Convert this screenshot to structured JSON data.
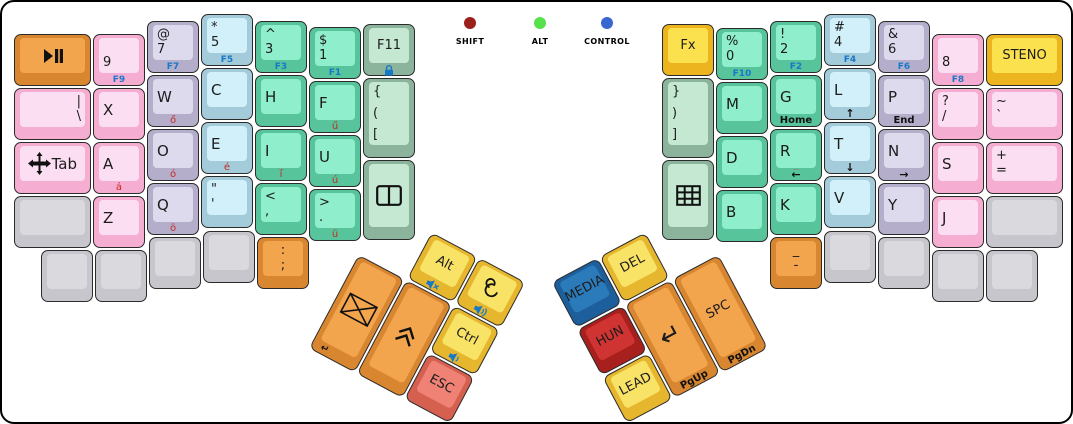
{
  "window": {
    "width": 1073,
    "height": 424,
    "background": "#ffffff",
    "border_color": "#000000"
  },
  "indicators": [
    {
      "name": "shift",
      "label": "SHIFT",
      "color": "#9b1f1a",
      "x": 468,
      "y": 21
    },
    {
      "name": "alt",
      "label": "ALT",
      "color": "#57e14b",
      "x": 538,
      "y": 21
    },
    {
      "name": "control",
      "label": "CONTROL",
      "color": "#3a66d2",
      "x": 605,
      "y": 21
    }
  ],
  "palette": {
    "pink": {
      "side": "#f5aed2",
      "face": "#fbdef1"
    },
    "lavender": {
      "side": "#b4aeca",
      "face": "#dedaee"
    },
    "cyan": {
      "side": "#a4cbd9",
      "face": "#d2f0fa"
    },
    "teal": {
      "side": "#58c49c",
      "face": "#8feecb"
    },
    "sage": {
      "side": "#8cb49c",
      "face": "#c4e8d1"
    },
    "gold": {
      "side": "#ecb51f",
      "face": "#fce14e"
    },
    "yellow": {
      "side": "#e5b62e",
      "face": "#f8e366"
    },
    "orange": {
      "side": "#d8862f",
      "face": "#f3a54e"
    },
    "salmon": {
      "side": "#d6604f",
      "face": "#ef8274"
    },
    "red": {
      "side": "#a8201e",
      "face": "#cf3432"
    },
    "blue": {
      "side": "#1d5e9c",
      "face": "#2b7ab9"
    },
    "gray": {
      "side": "#c6c6cc",
      "face": "#d9d9de"
    }
  },
  "keys": [
    {
      "name": "key-play-pause",
      "x": 12,
      "y": 32,
      "w": 77,
      "color": "orange",
      "center": "icon:play-pause"
    },
    {
      "name": "key-9",
      "x": 91,
      "y": 32,
      "color": "pink",
      "stack": [
        "",
        "9"
      ],
      "front": "F9",
      "fc": "blue"
    },
    {
      "name": "key-7",
      "x": 145,
      "y": 19,
      "color": "lavender",
      "stack": [
        "@",
        "7"
      ],
      "front": "F7",
      "fc": "blue"
    },
    {
      "name": "key-5",
      "x": 199,
      "y": 12,
      "color": "cyan",
      "stack": [
        "*",
        "5"
      ],
      "front": "F5",
      "fc": "blue"
    },
    {
      "name": "key-3",
      "x": 253,
      "y": 19,
      "color": "teal",
      "stack": [
        "^",
        "3"
      ],
      "front": "F3",
      "fc": "blue"
    },
    {
      "name": "key-1",
      "x": 307,
      "y": 25,
      "color": "teal",
      "stack": [
        "$",
        "1"
      ],
      "front": "F1",
      "fc": "blue"
    },
    {
      "name": "key-f11",
      "x": 361,
      "y": 22,
      "color": "sage",
      "center": "F11",
      "front": "icon:lock",
      "fc": "blue"
    },
    {
      "name": "key-pipe-backslash",
      "x": 12,
      "y": 86,
      "w": 77,
      "color": "pink",
      "stack": [
        "|",
        "\\"
      ],
      "align": "r"
    },
    {
      "name": "key-x",
      "x": 91,
      "y": 86,
      "color": "pink",
      "single": "X"
    },
    {
      "name": "key-w",
      "x": 145,
      "y": 73,
      "color": "lavender",
      "single": "W",
      "front": "ő",
      "fc": "red"
    },
    {
      "name": "key-c",
      "x": 199,
      "y": 66,
      "color": "cyan",
      "single": "C"
    },
    {
      "name": "key-h",
      "x": 253,
      "y": 73,
      "color": "teal",
      "single": "H"
    },
    {
      "name": "key-f",
      "x": 307,
      "y": 79,
      "color": "teal",
      "single": "F",
      "front": "ű",
      "fc": "red"
    },
    {
      "name": "key-brace-open",
      "x": 361,
      "y": 76,
      "h": 80,
      "color": "sage",
      "stack": [
        "{",
        "(",
        "["
      ]
    },
    {
      "name": "key-tab",
      "x": 12,
      "y": 140,
      "w": 77,
      "color": "pink",
      "row": [
        "icon:move",
        "Tab"
      ]
    },
    {
      "name": "key-a",
      "x": 91,
      "y": 140,
      "color": "pink",
      "single": "A",
      "front": "á",
      "fc": "red"
    },
    {
      "name": "key-o",
      "x": 145,
      "y": 127,
      "color": "lavender",
      "single": "O",
      "front": "ó",
      "fc": "red"
    },
    {
      "name": "key-e",
      "x": 199,
      "y": 120,
      "color": "cyan",
      "single": "E",
      "front": "é",
      "fc": "red"
    },
    {
      "name": "key-i",
      "x": 253,
      "y": 127,
      "color": "teal",
      "single": "I",
      "mid": "_",
      "front": "í",
      "fc": "red"
    },
    {
      "name": "key-u",
      "x": 307,
      "y": 133,
      "color": "teal",
      "single": "U",
      "front": "ú",
      "fc": "red"
    },
    {
      "name": "key-window",
      "x": 361,
      "y": 158,
      "h": 80,
      "color": "sage",
      "center": "icon:window-split"
    },
    {
      "name": "key-blank-l0",
      "x": 12,
      "y": 194,
      "w": 77,
      "color": "gray"
    },
    {
      "name": "key-z",
      "x": 91,
      "y": 194,
      "color": "pink",
      "single": "Z"
    },
    {
      "name": "key-q",
      "x": 145,
      "y": 181,
      "color": "lavender",
      "single": "Q",
      "front": "ö",
      "fc": "red"
    },
    {
      "name": "key-quote",
      "x": 199,
      "y": 174,
      "color": "cyan",
      "stack": [
        "\"",
        "'"
      ]
    },
    {
      "name": "key-comma",
      "x": 253,
      "y": 181,
      "color": "teal",
      "stack": [
        "<",
        ","
      ]
    },
    {
      "name": "key-period",
      "x": 307,
      "y": 187,
      "color": "teal",
      "stack": [
        ">",
        "."
      ],
      "front": "ü",
      "fc": "red"
    },
    {
      "name": "key-blank-l1",
      "x": 39,
      "y": 248,
      "color": "gray"
    },
    {
      "name": "key-blank-l2",
      "x": 93,
      "y": 248,
      "color": "gray"
    },
    {
      "name": "key-blank-l3",
      "x": 147,
      "y": 235,
      "color": "gray"
    },
    {
      "name": "key-blank-l4",
      "x": 201,
      "y": 229,
      "color": "gray"
    },
    {
      "name": "key-colon",
      "x": 255,
      "y": 235,
      "color": "orange",
      "stack": [
        ":",
        ";"
      ],
      "align": "c"
    },
    {
      "name": "key-fx",
      "x": 660,
      "y": 22,
      "color": "gold",
      "center": "Fx"
    },
    {
      "name": "key-0",
      "x": 714,
      "y": 26,
      "color": "teal",
      "stack": [
        "%",
        "0"
      ],
      "front": "F10",
      "fc": "blue"
    },
    {
      "name": "key-2",
      "x": 768,
      "y": 19,
      "color": "teal",
      "stack": [
        "!",
        "2"
      ],
      "front": "F2",
      "fc": "blue"
    },
    {
      "name": "key-4",
      "x": 822,
      "y": 12,
      "color": "cyan",
      "stack": [
        "#",
        "4"
      ],
      "front": "F4",
      "fc": "blue"
    },
    {
      "name": "key-6",
      "x": 876,
      "y": 19,
      "color": "lavender",
      "stack": [
        "&",
        "6"
      ],
      "front": "F6",
      "fc": "blue"
    },
    {
      "name": "key-8",
      "x": 930,
      "y": 32,
      "color": "pink",
      "stack": [
        "",
        "8"
      ],
      "front": "F8",
      "fc": "blue"
    },
    {
      "name": "key-steno",
      "x": 984,
      "y": 32,
      "w": 77,
      "color": "gold",
      "center": "STENO"
    },
    {
      "name": "key-brace-close",
      "x": 660,
      "y": 76,
      "h": 80,
      "color": "sage",
      "stack": [
        "}",
        ")",
        "]"
      ]
    },
    {
      "name": "key-m",
      "x": 714,
      "y": 80,
      "color": "teal",
      "single": "M"
    },
    {
      "name": "key-g",
      "x": 768,
      "y": 73,
      "color": "teal",
      "single": "G",
      "front": "Home",
      "fc": "dark"
    },
    {
      "name": "key-l",
      "x": 822,
      "y": 66,
      "color": "cyan",
      "single": "L",
      "front": "↑",
      "fc": "dark",
      "arrow": true
    },
    {
      "name": "key-p",
      "x": 876,
      "y": 73,
      "color": "lavender",
      "single": "P",
      "front": "End",
      "fc": "dark"
    },
    {
      "name": "key-question",
      "x": 930,
      "y": 86,
      "color": "pink",
      "stack": [
        "?",
        "/"
      ]
    },
    {
      "name": "key-tilde",
      "x": 984,
      "y": 86,
      "w": 77,
      "color": "pink",
      "stack": [
        "~",
        "`"
      ]
    },
    {
      "name": "key-keypad",
      "x": 660,
      "y": 158,
      "h": 80,
      "color": "sage",
      "center": "icon:keypad"
    },
    {
      "name": "key-d",
      "x": 714,
      "y": 134,
      "color": "teal",
      "single": "D"
    },
    {
      "name": "key-r",
      "x": 768,
      "y": 127,
      "color": "teal",
      "single": "R",
      "mid": "_",
      "front": "←",
      "fc": "dark",
      "arrow": true
    },
    {
      "name": "key-t",
      "x": 822,
      "y": 120,
      "color": "cyan",
      "single": "T",
      "front": "↓",
      "fc": "dark",
      "arrow": true
    },
    {
      "name": "key-n",
      "x": 876,
      "y": 127,
      "color": "lavender",
      "single": "N",
      "front": "→",
      "fc": "dark",
      "arrow": true
    },
    {
      "name": "key-s",
      "x": 930,
      "y": 140,
      "color": "pink",
      "single": "S"
    },
    {
      "name": "key-plus",
      "x": 984,
      "y": 140,
      "w": 77,
      "color": "pink",
      "stack": [
        "+",
        "="
      ]
    },
    {
      "name": "key-b",
      "x": 714,
      "y": 188,
      "color": "teal",
      "single": "B"
    },
    {
      "name": "key-k",
      "x": 768,
      "y": 181,
      "color": "teal",
      "single": "K"
    },
    {
      "name": "key-v",
      "x": 822,
      "y": 174,
      "color": "cyan",
      "single": "V"
    },
    {
      "name": "key-y",
      "x": 876,
      "y": 181,
      "color": "lavender",
      "single": "Y"
    },
    {
      "name": "key-j",
      "x": 930,
      "y": 194,
      "color": "pink",
      "single": "J"
    },
    {
      "name": "key-blank-r0",
      "x": 984,
      "y": 194,
      "w": 77,
      "color": "gray"
    },
    {
      "name": "key-minus",
      "x": 768,
      "y": 235,
      "color": "orange",
      "stack": [
        "_",
        "-"
      ],
      "align": "c"
    },
    {
      "name": "key-blank-r1",
      "x": 822,
      "y": 229,
      "color": "gray"
    },
    {
      "name": "key-blank-r2",
      "x": 876,
      "y": 235,
      "color": "gray"
    },
    {
      "name": "key-blank-r3",
      "x": 930,
      "y": 248,
      "color": "gray"
    },
    {
      "name": "key-blank-r4",
      "x": 984,
      "y": 248,
      "color": "gray"
    }
  ],
  "clusters": [
    {
      "name": "left-thumb-cluster",
      "x": 382,
      "y": 205,
      "rotate": 28,
      "origin": "0px 0px",
      "keys": [
        {
          "name": "key-alt",
          "x": 54,
          "y": 0,
          "color": "yellow",
          "center": "Alt",
          "front": "icon:vol-mute"
        },
        {
          "name": "key-debian",
          "x": 108,
          "y": 0,
          "color": "yellow",
          "center": "icon:debian",
          "front": "icon:vol-up"
        },
        {
          "name": "key-mail",
          "x": 0,
          "y": 54,
          "h": 106,
          "color": "orange",
          "center": "icon:envelope",
          "front": "↵",
          "fc": "dark",
          "frontAlign": "l"
        },
        {
          "name": "key-chevrons-up",
          "x": 54,
          "y": 54,
          "h": 106,
          "color": "orange",
          "center": "icon:chevrons-up"
        },
        {
          "name": "key-ctrl",
          "x": 108,
          "y": 54,
          "color": "yellow",
          "center": "Ctrl",
          "front": "icon:vol-down"
        },
        {
          "name": "key-esc",
          "x": 108,
          "y": 108,
          "color": "salmon",
          "center": "ESC"
        }
      ]
    },
    {
      "name": "right-thumb-cluster",
      "x": 531,
      "y": 205,
      "rotate": -28,
      "origin": "160px 0px",
      "keys": [
        {
          "name": "key-media",
          "x": 0,
          "y": 0,
          "color": "blue",
          "center": "MEDIA"
        },
        {
          "name": "key-del",
          "x": 54,
          "y": 0,
          "color": "yellow",
          "center": "DEL"
        },
        {
          "name": "key-hun",
          "x": 0,
          "y": 54,
          "color": "red",
          "center": "HUN"
        },
        {
          "name": "key-lead",
          "x": 0,
          "y": 108,
          "color": "yellow",
          "center": "LEAD"
        },
        {
          "name": "key-enter",
          "x": 54,
          "y": 54,
          "h": 106,
          "color": "orange",
          "center": "↵",
          "big": true,
          "front": "PgUp",
          "fc": "dark"
        },
        {
          "name": "key-space",
          "x": 108,
          "y": 54,
          "h": 106,
          "color": "orange",
          "center": "SPC",
          "front": "PgDn",
          "fc": "dark"
        }
      ]
    }
  ]
}
